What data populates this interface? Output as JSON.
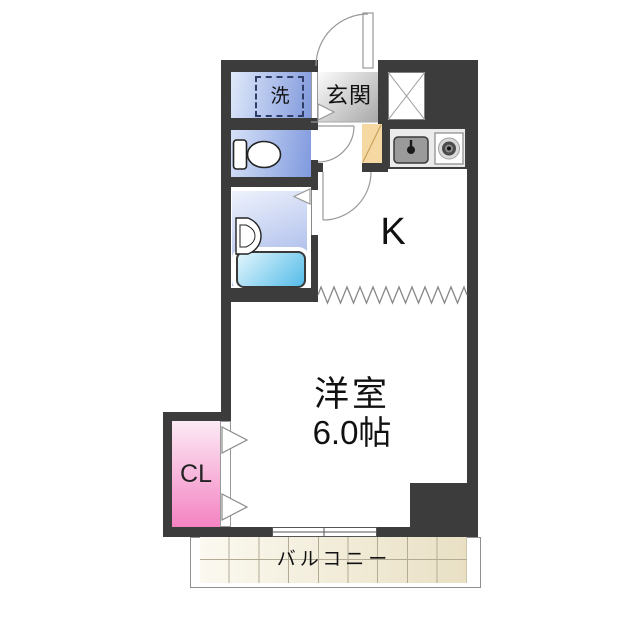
{
  "rooms": {
    "laundry": {
      "label": "洗"
    },
    "entrance": {
      "label": "玄関"
    },
    "kitchen": {
      "label": "K"
    },
    "western_room": {
      "label": "洋室",
      "size": "6.0帖"
    },
    "closet": {
      "label": "CL"
    },
    "balcony": {
      "label": "バルコニー"
    }
  },
  "icons": [
    "toilet-icon",
    "bathtub-icon",
    "wash-basin-icon",
    "kitchen-sink-icon",
    "stove-burner-icon",
    "washer-space-icon",
    "storage-x-box-icon",
    "shoe-cabinet-icon",
    "entrance-door-arc-icon",
    "toilet-door-arc-icon",
    "kitchen-door-arc-icon",
    "bath-folding-door-icon",
    "closet-folding-door-icon",
    "sliding-window-icon",
    "room-divider-zigzag-icon"
  ],
  "colors": {
    "wall": "#3c3c3c",
    "laundry_light": "#dfe9fa",
    "laundry_dark": "#8199dc",
    "toilet_light": "#d6e1f7",
    "toilet_dark": "#7f99de",
    "bath_light": "#eef2fc",
    "bath_dark": "#9aaee7",
    "tub_light": "#e2f5fc",
    "tub_dark": "#54bce9",
    "entrance_light": "#fbfbfb",
    "entrance_dark": "#a8a8a8",
    "closet_light": "#fceaf5",
    "closet_dark": "#f483c2",
    "shoe_cabinet": "#f6d9a2",
    "balcony_tile": "#e9e0c4",
    "counter": "#ebebeb",
    "sink": "#9a9a9a"
  }
}
